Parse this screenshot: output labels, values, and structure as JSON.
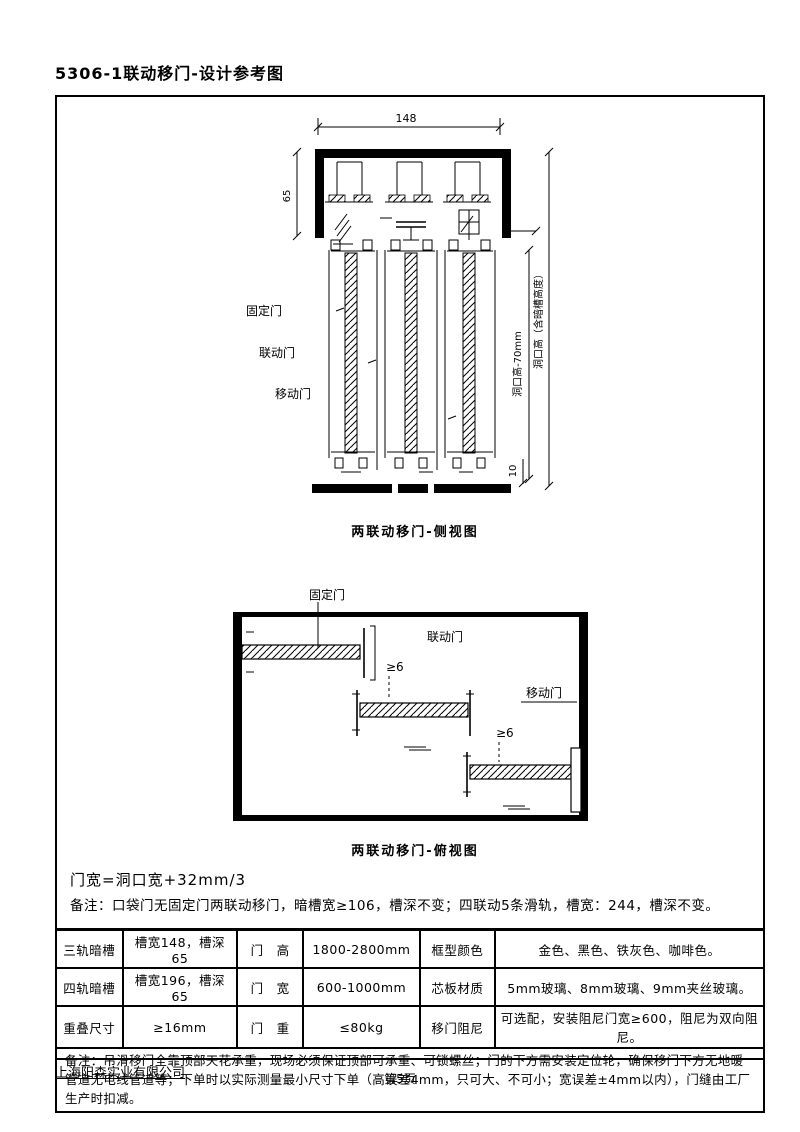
{
  "page": {
    "title": "5306-1联动移门-设计参考图",
    "footer_company": "上海阳森实业有限公司",
    "footer_page": "第5页"
  },
  "drawing_side": {
    "caption": "两联动移门-侧视图",
    "dim_track_width": "148",
    "dim_track_height": "65",
    "dim_floor_gap": "10",
    "dim_right_inner": "洞口高-70mm",
    "dim_right_outer": "洞口高（含暗槽高度）",
    "label_fixed": "固定门",
    "label_linked": "联动门",
    "label_moving": "移动门"
  },
  "drawing_plan": {
    "caption": "两联动移门-俯视图",
    "label_fixed": "固定门",
    "label_linked": "联动门",
    "label_moving": "移动门",
    "gap1": "≥6",
    "gap2": "≥6"
  },
  "notes": {
    "formula": "门宽=洞口宽+32mm/3",
    "remark": "备注：口袋门无固定门两联动移门，暗槽宽≥106，槽深不变；四联动5条滑轨，槽宽：244，槽深不变。"
  },
  "spec_table": {
    "rows": [
      {
        "c1": "三轨暗槽",
        "c2": "槽宽148，槽深65",
        "c3": "门　高",
        "c4": "1800-2800mm",
        "c5": "框型颜色",
        "c6": "金色、黑色、铁灰色、咖啡色。"
      },
      {
        "c1": "四轨暗槽",
        "c2": "槽宽196，槽深65",
        "c3": "门　宽",
        "c4": "600-1000mm",
        "c5": "芯板材质",
        "c6": "5mm玻璃、8mm玻璃、9mm夹丝玻璃。"
      },
      {
        "c1": "重叠尺寸",
        "c2": "≥16mm",
        "c3": "门　重",
        "c4": "≤80kg",
        "c5": "移门阻尼",
        "c6": "可选配，安装阻尼门宽≥600，阻尼为双向阻尼。"
      }
    ],
    "note": "备注：吊滑移门全靠顶部天花承重，现场必须保证顶部可承重、可锁螺丝；门的下方需安装定位轮，确保移门下方无地暖管道无电线管道等；下单时以实际测量最小尺寸下单（高误差4mm，只可大、不可小；宽误差±4mm以内），门缝由工厂生产时扣减。"
  },
  "colors": {
    "ink": "#000000",
    "paper": "#ffffff"
  }
}
